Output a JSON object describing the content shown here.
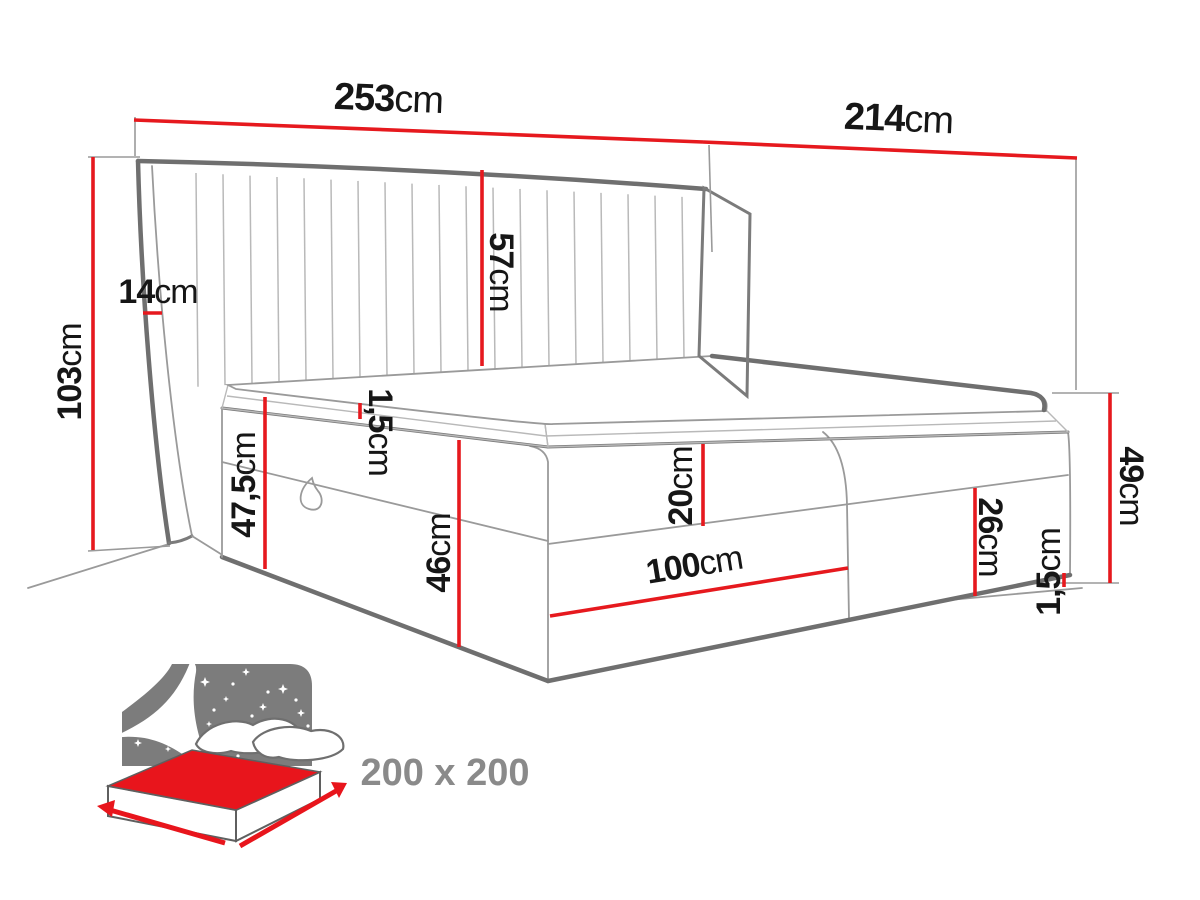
{
  "colors": {
    "background": "#ffffff",
    "dimension_line_red": "#e6191e",
    "drawing_line_gray": "#6f6f6f",
    "label_text": "#161616",
    "icon_panel_gray": "#7c7c7c",
    "icon_mattress_red": "#e8151c",
    "badge_text_gray": "#8a8a8a"
  },
  "diagram": {
    "dimensions": {
      "headboard_width": {
        "num": "253",
        "unit": "cm"
      },
      "bed_depth": {
        "num": "214",
        "unit": "cm"
      },
      "headboard_height": {
        "num": "103",
        "unit": "cm"
      },
      "wing_thickness": {
        "num": "14",
        "unit": "cm"
      },
      "headboard_panel_height": {
        "num": "57",
        "unit": "cm"
      },
      "mattress_lip": {
        "num": "1,5",
        "unit": "cm"
      },
      "left_total_height": {
        "num": "47,5",
        "unit": "cm"
      },
      "base_height": {
        "num": "46",
        "unit": "cm"
      },
      "upper_box_height": {
        "num": "20",
        "unit": "cm"
      },
      "storage_width": {
        "num": "100",
        "unit": "cm"
      },
      "lower_box_height": {
        "num": "26",
        "unit": "cm"
      },
      "side_total_height": {
        "num": "49",
        "unit": "cm"
      },
      "floor_gap": {
        "num": "1,5",
        "unit": "cm"
      }
    }
  },
  "badge": {
    "size_label": "200 x 200"
  }
}
